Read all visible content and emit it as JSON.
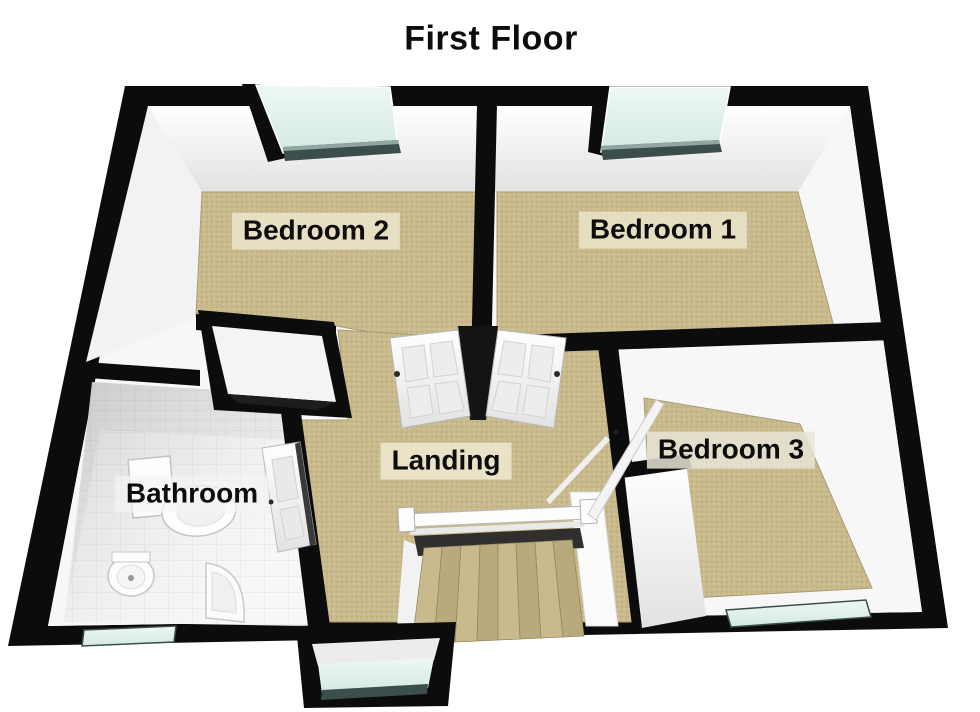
{
  "title": "First Floor",
  "rooms": {
    "bedroom2": {
      "label": "Bedroom 2"
    },
    "bedroom1": {
      "label": "Bedroom 1"
    },
    "bedroom3": {
      "label": "Bedroom 3"
    },
    "landing": {
      "label": "Landing"
    },
    "bathroom": {
      "label": "Bathroom"
    }
  },
  "colors": {
    "wall_outline": "#0c0c0c",
    "inner_wall": "#f7f7f7",
    "carpet": "#c9ba8d",
    "window_glass": "#ddf0e9",
    "window_frame": "#3c4e4b",
    "bathroom_tile": "#f6f6f6",
    "label_background": "#e9e2c6",
    "text": "#0d0d0d"
  }
}
